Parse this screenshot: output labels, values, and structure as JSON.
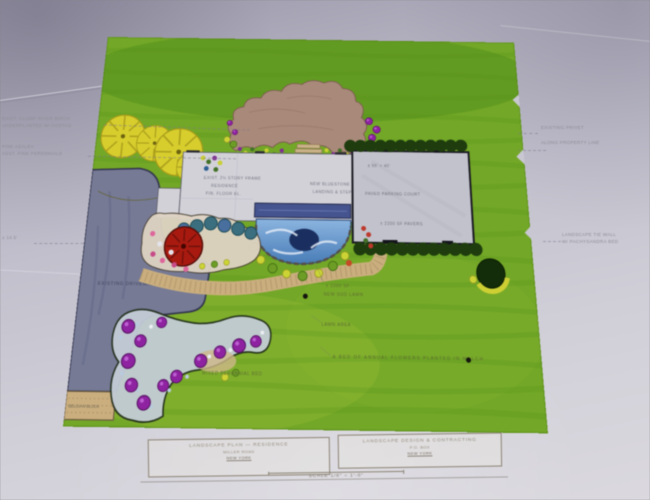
{
  "colors": {
    "paper": "#c6c4cf",
    "lawn": "#74a62c",
    "lawn_shadow": "#4f8c1d",
    "patio": "#a8897b",
    "driveway": "#767a94",
    "walk_tan": "#c9ae80",
    "house": "#d2d1d8",
    "court": "#c2c2cc",
    "porch_deck": "#46548c",
    "pond_light": "#7aa6d6",
    "pond_deep": "#1b2f5e",
    "hedge": "#1f3c10",
    "tree_yellow": "#d6ce35",
    "tree_red": "#a31b12",
    "shrub_purple": "#8a249c",
    "shrub_teal": "#3d6f7f",
    "annotation_ink": "#8e8c96",
    "plan_ink": "#5d6b35"
  },
  "margin_annotations": {
    "left": [
      {
        "line1": "EXIST.  CLUMP  RIVER  BIRCH",
        "line2": "UNDERPLANTED  W/  HOSTAS"
      },
      {
        "line1": "PINK  AZALEA",
        "line2": "ASST.  PINK  PERENNIALS"
      },
      {
        "line1": "± 14.5'",
        "line2": ""
      }
    ],
    "right": [
      {
        "line1": "EXISTING  PRIVET",
        "line2": "ALONG  PROPERTY  LINE"
      },
      {
        "line1": "LANDSCAPE  TIE  WALL",
        "line2": "W/  PACHYSANDRA  BED"
      }
    ]
  },
  "plan_labels": {
    "driveway": "EXISTING  DRIVEWAY",
    "apron": "BELGIAN  BLOCK",
    "house_line1": "EXIST.  2½  STORY  FRAME",
    "house_line2": "RESIDENCE",
    "house_line3": "FIN.  FLOOR  EL.",
    "porch_line1": "NEW  BLUESTONE",
    "porch_line2": "LANDING  &  STEPS",
    "court_line1": "± 55' × 40'",
    "court_line2": "PAVED  PARKING  COURT",
    "court_line3": "± 2200  SF  PAVERS",
    "lawn_line1": "± 1200  SF",
    "lawn_line2": "NEW  SOD  LAWN",
    "lawn_line3": "LAWN  AREA",
    "bed_note": "A  BED  OF  ANNUAL  FLOWERS  PLANTED  IN  MULCH",
    "garden_note": "MIXED  PERENNIAL  BED"
  },
  "title_block": {
    "project_line1": "LANDSCAPE  PLAN  —  RESIDENCE",
    "project_line2": "MILLER  ROAD",
    "project_line3": "NEW  YORK",
    "designer_line1": "LANDSCAPE  DESIGN  &  CONTRACTING",
    "designer_line2": "P.O.  BOX",
    "designer_line3": "NEW  YORK",
    "scale": "SCALE  1/8\" = 1'-0\""
  }
}
